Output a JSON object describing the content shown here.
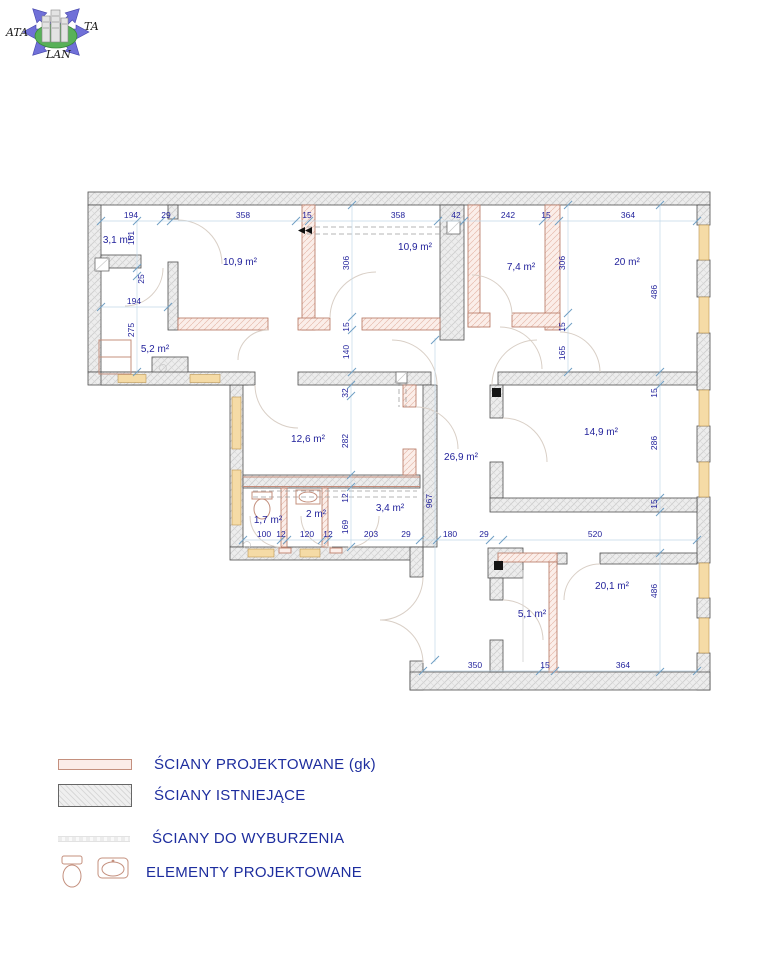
{
  "logo": {
    "left": "ATA",
    "right": "TA",
    "bottom": "LAN"
  },
  "legend": {
    "items": [
      {
        "label": "ŚCIANY PROJEKTOWANE (gk)",
        "swatch": "projected-wall"
      },
      {
        "label": "ŚCIANY ISTNIEJĄCE",
        "swatch": "existing-wall"
      },
      {
        "label": "ŚCIANY DO WYBURZENIA",
        "swatch": "demolition-wall"
      },
      {
        "label": "ELEMENTY PROJEKTOWANE",
        "swatch": "fixtures"
      }
    ]
  },
  "colors": {
    "label_navy": "#1f1f9a",
    "legend_navy": "#1d2d9e",
    "projected_wall": "#c4907e",
    "existing_wall_fill": "#ededed",
    "window_fill": "#f5dba6"
  },
  "plan": {
    "room_labels": [
      {
        "text": "3,1 m²",
        "x": 117,
        "y": 243
      },
      {
        "text": "10,9 m²",
        "x": 240,
        "y": 265
      },
      {
        "text": "10,9 m²",
        "x": 415,
        "y": 250
      },
      {
        "text": "7,4 m²",
        "x": 521,
        "y": 270
      },
      {
        "text": "20 m²",
        "x": 627,
        "y": 265
      },
      {
        "text": "5,2 m²",
        "x": 155,
        "y": 352
      },
      {
        "text": "12,6 m²",
        "x": 308,
        "y": 442
      },
      {
        "text": "26,9 m²",
        "x": 461,
        "y": 460
      },
      {
        "text": "14,9 m²",
        "x": 601,
        "y": 435
      },
      {
        "text": "1,7 m²",
        "x": 268,
        "y": 523
      },
      {
        "text": "2 m²",
        "x": 316,
        "y": 517
      },
      {
        "text": "3,4 m²",
        "x": 390,
        "y": 511
      },
      {
        "text": "5,1 m²",
        "x": 532,
        "y": 617
      },
      {
        "text": "20,1 m²",
        "x": 612,
        "y": 589
      }
    ],
    "dimensions": [
      {
        "text": "194",
        "x": 131,
        "y": 218,
        "rot": 0
      },
      {
        "text": "29",
        "x": 166,
        "y": 218,
        "rot": 0
      },
      {
        "text": "358",
        "x": 243,
        "y": 218,
        "rot": 0
      },
      {
        "text": "15",
        "x": 307,
        "y": 218,
        "rot": 0
      },
      {
        "text": "358",
        "x": 398,
        "y": 218,
        "rot": 0
      },
      {
        "text": "42",
        "x": 456,
        "y": 218,
        "rot": 0
      },
      {
        "text": "242",
        "x": 508,
        "y": 218,
        "rot": 0
      },
      {
        "text": "15",
        "x": 546,
        "y": 218,
        "rot": 0
      },
      {
        "text": "364",
        "x": 628,
        "y": 218,
        "rot": 0
      },
      {
        "text": "161",
        "x": 134,
        "y": 238,
        "rot": 1
      },
      {
        "text": "25",
        "x": 144,
        "y": 279,
        "rot": 1
      },
      {
        "text": "194",
        "x": 134,
        "y": 304,
        "rot": 0
      },
      {
        "text": "275",
        "x": 134,
        "y": 330,
        "rot": 1
      },
      {
        "text": "306",
        "x": 349,
        "y": 263,
        "rot": 1
      },
      {
        "text": "15",
        "x": 349,
        "y": 327,
        "rot": 1
      },
      {
        "text": "140",
        "x": 349,
        "y": 352,
        "rot": 1
      },
      {
        "text": "306",
        "x": 565,
        "y": 263,
        "rot": 1
      },
      {
        "text": "15",
        "x": 565,
        "y": 327,
        "rot": 1
      },
      {
        "text": "165",
        "x": 565,
        "y": 353,
        "rot": 1
      },
      {
        "text": "486",
        "x": 657,
        "y": 292,
        "rot": 1
      },
      {
        "text": "15",
        "x": 657,
        "y": 393,
        "rot": 1
      },
      {
        "text": "286",
        "x": 657,
        "y": 443,
        "rot": 1
      },
      {
        "text": "15",
        "x": 657,
        "y": 504,
        "rot": 1
      },
      {
        "text": "486",
        "x": 657,
        "y": 591,
        "rot": 1
      },
      {
        "text": "32",
        "x": 348,
        "y": 393,
        "rot": 1
      },
      {
        "text": "282",
        "x": 348,
        "y": 441,
        "rot": 1
      },
      {
        "text": "12",
        "x": 348,
        "y": 498,
        "rot": 1
      },
      {
        "text": "169",
        "x": 348,
        "y": 527,
        "rot": 1
      },
      {
        "text": "967",
        "x": 432,
        "y": 501,
        "rot": 1
      },
      {
        "text": "100",
        "x": 264,
        "y": 537,
        "rot": 0
      },
      {
        "text": "12",
        "x": 281,
        "y": 537,
        "rot": 0
      },
      {
        "text": "120",
        "x": 307,
        "y": 537,
        "rot": 0
      },
      {
        "text": "12",
        "x": 328,
        "y": 537,
        "rot": 0
      },
      {
        "text": "203",
        "x": 371,
        "y": 537,
        "rot": 0
      },
      {
        "text": "29",
        "x": 406,
        "y": 537,
        "rot": 0
      },
      {
        "text": "180",
        "x": 450,
        "y": 537,
        "rot": 0
      },
      {
        "text": "29",
        "x": 484,
        "y": 537,
        "rot": 0
      },
      {
        "text": "520",
        "x": 595,
        "y": 537,
        "rot": 0
      },
      {
        "text": "350",
        "x": 475,
        "y": 668,
        "rot": 0
      },
      {
        "text": "15",
        "x": 545,
        "y": 668,
        "rot": 0
      },
      {
        "text": "364",
        "x": 623,
        "y": 668,
        "rot": 0
      }
    ]
  }
}
